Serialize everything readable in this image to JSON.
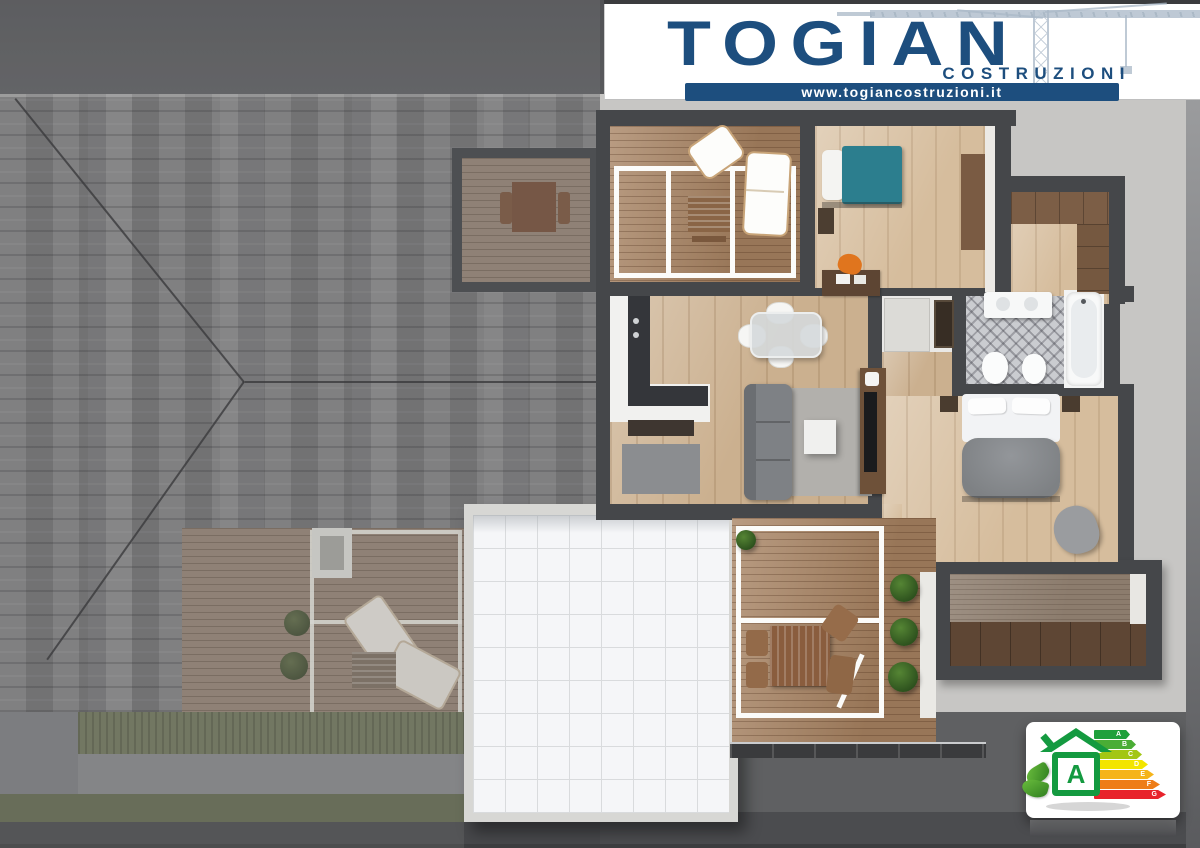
{
  "branding": {
    "company": "TOGIAN",
    "tagline": "COSTRUZIONI",
    "website": "www.togiancostruzioni.it",
    "navy": "#1d4e7e"
  },
  "energy_label": {
    "house_class": "A",
    "house_green": "#149a40",
    "classes": [
      {
        "label": "A",
        "color": "#1fa03c"
      },
      {
        "label": "B",
        "color": "#4aad35"
      },
      {
        "label": "C",
        "color": "#a3c614"
      },
      {
        "label": "D",
        "color": "#f3e500"
      },
      {
        "label": "E",
        "color": "#f5b41a"
      },
      {
        "label": "F",
        "color": "#ee7d17"
      },
      {
        "label": "G",
        "color": "#e8232b"
      }
    ]
  },
  "palette": {
    "roof_shingle": "#717173",
    "ground": "#c7c6c4",
    "wall_charcoal": "#45474a",
    "deck_wood": "#a5805f",
    "interior_oak": "#cbb08f",
    "teal_bed": "#2c7e8e",
    "orange_chair": "#e0751e",
    "tiled_terrace": "#f5f6f8"
  }
}
